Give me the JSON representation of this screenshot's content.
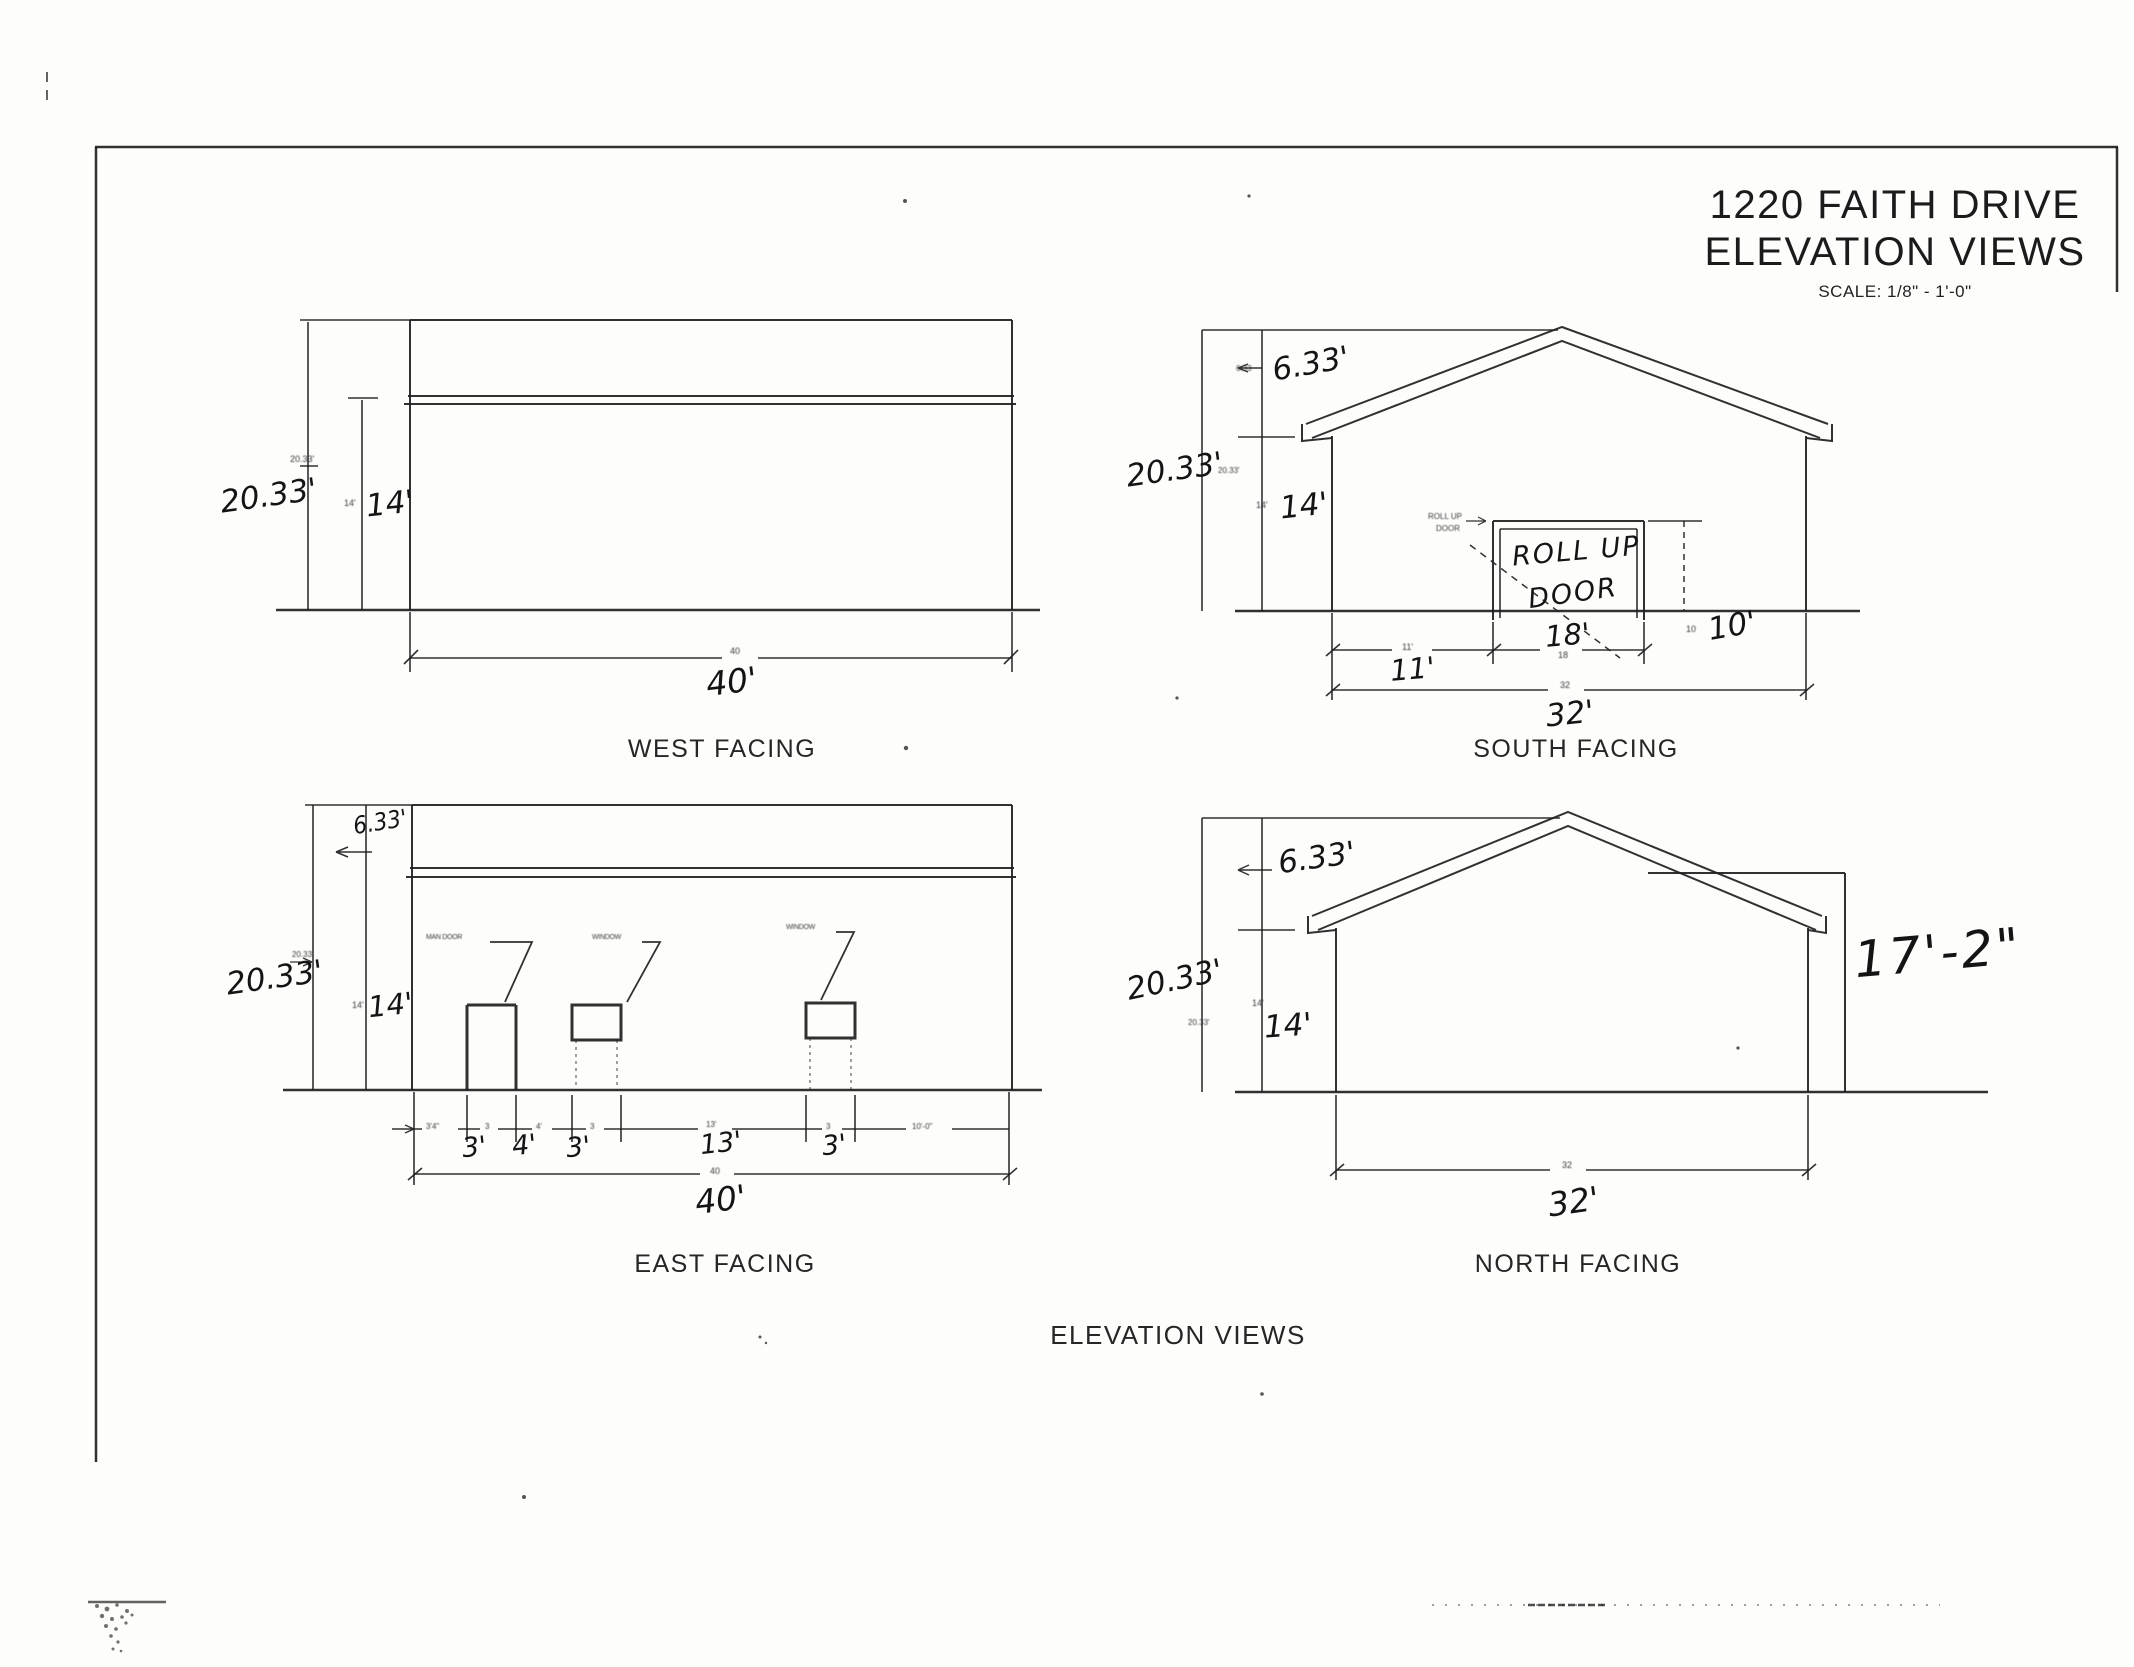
{
  "document": {
    "title_line1": "1220 FAITH DRIVE",
    "title_line2": "ELEVATION VIEWS",
    "scale_note": "SCALE: 1/8\" - 1'-0\"",
    "footer_label": "ELEVATION VIEWS"
  },
  "views": {
    "west": {
      "label": "WEST FACING",
      "dim_total_height_hand": "20.33'",
      "dim_total_height_printed": "20.33'",
      "dim_eave_height_hand": "14'",
      "dim_eave_height_printed": "14'",
      "dim_width_hand": "40'",
      "dim_width_printed": "40"
    },
    "south": {
      "label": "SOUTH FACING",
      "dim_total_height_hand": "20.33'",
      "dim_total_height_printed": "20.33'",
      "dim_gable_height_hand": "6.33'",
      "dim_gable_height_printed": "6.33",
      "dim_eave_height_hand": "14'",
      "dim_eave_height_printed": "14'",
      "door_note_hand_line1": "ROLL UP",
      "door_note_hand_line2": "DOOR",
      "door_note_printed_line1": "ROLL UP",
      "door_note_printed_line2": "DOOR",
      "dim_door_height_hand": "10'",
      "dim_door_height_printed": "10",
      "dim_door_offset_hand": "11'",
      "dim_door_offset_printed": "11'",
      "dim_door_width_hand": "18'",
      "dim_door_width_printed": "18",
      "dim_width_hand": "32'",
      "dim_width_printed": "32"
    },
    "east": {
      "label": "EAST FACING",
      "dim_total_height_hand": "20.33'",
      "dim_total_height_printed": "20.33'",
      "dim_gable_height_hand": "6.33'",
      "dim_eave_height_hand": "14'",
      "dim_eave_height_printed": "14'",
      "opening_labels_printed": [
        "MAN DOOR",
        "WINDOW",
        "WINDOW"
      ],
      "segment_dims_printed": [
        "3'4\"",
        "3",
        "4'",
        "3",
        "13'",
        "3",
        "10'-0\""
      ],
      "segment_dims_hand": [
        "3'",
        "4'",
        "3'",
        "13'",
        "3'"
      ],
      "dim_width_hand": "40'",
      "dim_width_printed": "40"
    },
    "north": {
      "label": "NORTH FACING",
      "dim_total_height_hand": "20.33'",
      "dim_total_height_printed": "20.33'",
      "dim_gable_height_hand": "6.33'",
      "dim_eave_height_hand": "14'",
      "dim_eave_height_printed": "14'",
      "dim_right_height_hand": "17'-2\"",
      "dim_width_hand": "32'",
      "dim_width_printed": "32"
    }
  }
}
